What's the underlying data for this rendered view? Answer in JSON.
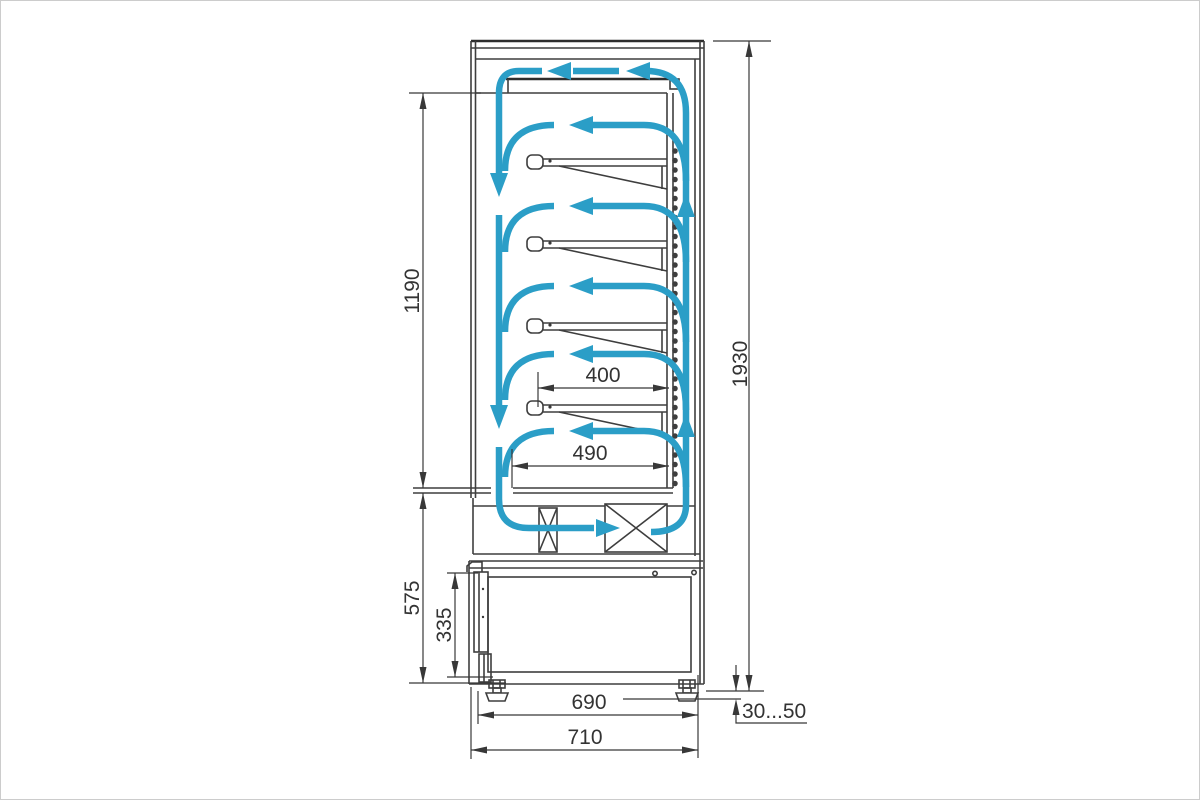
{
  "diagram": {
    "colors": {
      "airflow": "#2b9ec7",
      "outline": "#3e3e3e",
      "dimension_text": "#333333",
      "background": "#ffffff"
    },
    "dimensions": {
      "display_opening_height": "1190",
      "overall_height": "1930",
      "shelf_depth": "400",
      "bottom_deck_depth": "490",
      "base_section_height": "575",
      "service_door_height": "335",
      "base_depth": "690",
      "overall_depth": "710",
      "adjustable_foot_range": "30...50"
    }
  }
}
